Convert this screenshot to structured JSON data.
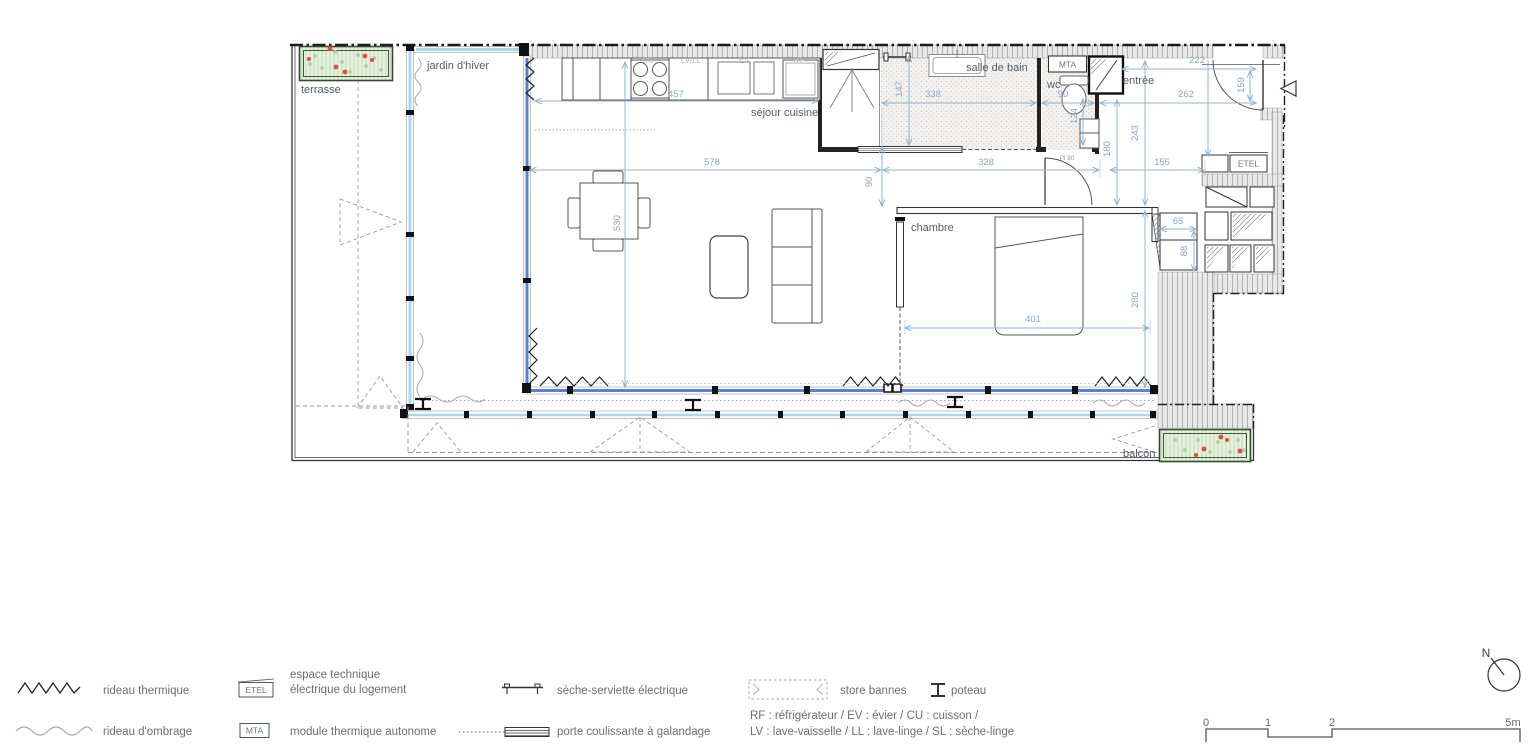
{
  "plan": {
    "rooms": {
      "terrasse": "terrasse",
      "jardin_hiver": "jardin d'hiver",
      "sejour_cuisine": "séjour cuisine",
      "salle_de_bain": "salle de bain",
      "wc": "wc",
      "entree": "entrée",
      "chambre": "chambre",
      "balcon": "balcon"
    },
    "boxes": {
      "mta": "MTA",
      "etel": "ETEL"
    },
    "appliances": {
      "cu": "CU",
      "lvll": "LV/LL",
      "ev": "EV",
      "rf": "RF"
    },
    "door_label": "Pl 80",
    "dims": {
      "kitchen_457": "457",
      "sejour_578": "578",
      "sejour_530": "530",
      "sejour_90": "90",
      "sdb_147": "147",
      "sdb_338": "338",
      "wc_90": "90",
      "wc_124": "124",
      "entree_222": "222",
      "entree_262": "262",
      "entree_159": "159",
      "entree_243": "243",
      "entree_180": "180",
      "hall_328": "328",
      "hall_155": "155",
      "chambre_401": "401",
      "chambre_280": "280",
      "closet_65": "65",
      "closet_88": "88"
    }
  },
  "legend": {
    "rideau_thermique": "rideau thermique",
    "rideau_ombrage": "rideau d'ombrage",
    "etel_box": "ETEL",
    "etel_l1": "espace technique",
    "etel_l2": "électrique du logement",
    "mta_box": "MTA",
    "mta_label": "module thermique autonome",
    "seche": "sèche-serviette électrique",
    "porte": "porte coulissante à galandage",
    "store": "store bannes",
    "poteau": "poteau",
    "abbr1": "RF : réfrigérateur / EV : évier / CU : cuisson /",
    "abbr2": "LV : lave-vaisselle / LL : lave-linge / SL : sèche-linge"
  },
  "scalebar": {
    "t0": "0",
    "t1": "1",
    "t2": "2",
    "t5": "5m"
  },
  "compass": {
    "north": "N"
  },
  "colors": {
    "dim": "#85abc8",
    "glazing_dark": "#5b7fd6",
    "glazing_light": "#a9d7f2",
    "planter": "#e7f2e0",
    "flower": "#e54a42"
  }
}
